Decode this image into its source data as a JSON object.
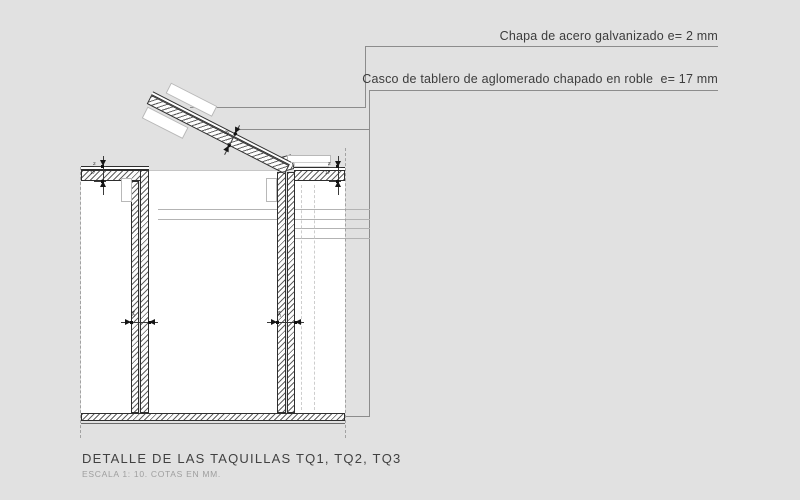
{
  "drawing": {
    "callouts": [
      {
        "label": "Chapa de acero galvanizado e= 2 mm"
      },
      {
        "label": "Casco de tablero de aglomerado chapado en roble  e= 17 mm"
      }
    ],
    "dims": {
      "steel_thickness": "2",
      "board_thickness": "17",
      "lid_thickness": "19",
      "partition_thickness": "34"
    },
    "title": "DETALLE DE LAS TAQUILLAS TQ1, TQ2, TQ3",
    "scale_note": "ESCALA 1: 10. COTAS EN MM."
  },
  "colors": {
    "background": "#e1e1e1",
    "drawing_line": "#2e2e2e",
    "leader_line": "#8c8c8c",
    "text": "#3c3c3c",
    "muted_text": "#9e9e9e"
  }
}
